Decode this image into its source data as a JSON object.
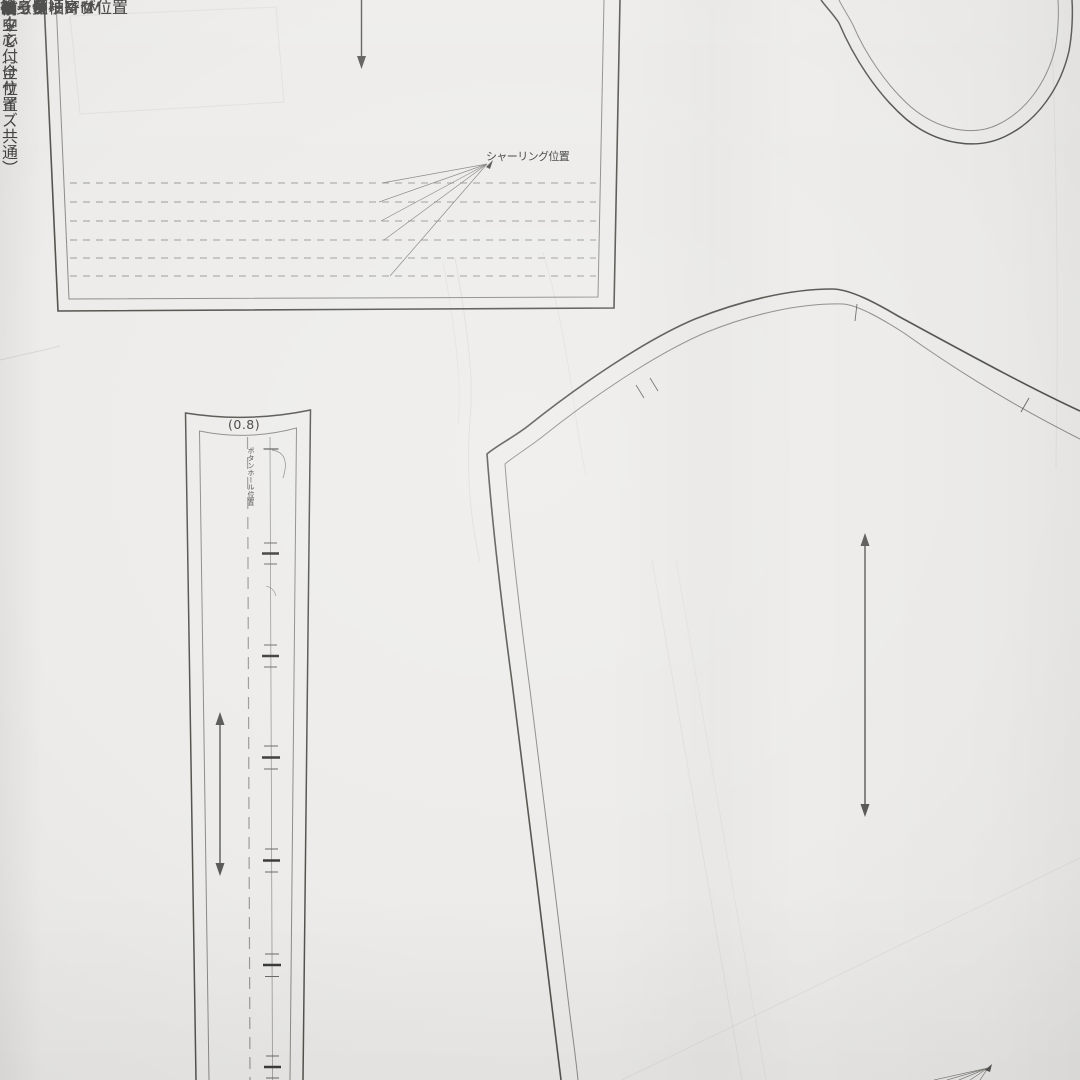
{
  "colors": {
    "paper": "#edecea",
    "outline_dark": "#4f4f4d",
    "outline_mid": "#8b8b89",
    "dashed_line": "#9b9b99",
    "text": "#3f3f3d"
  },
  "pieces": {
    "yoke_top": {
      "shirring_label": "シャーリング位置"
    },
    "placket": {
      "seam_allowance": "(0.8)",
      "buttonhole_label": "ボタンホール位置",
      "button_attach_label": "ボタン付け位置",
      "name_main": "前立て",
      "name_sub": "（全サイズ共通）",
      "center_front_label": "前中心"
    },
    "sleeve": {
      "back_side_label": "後ろ側",
      "name": "袖（長袖）　M",
      "shirring_label": "シャーリング位置"
    },
    "bleed_through": {
      "yoke_label": "ヨーク　M",
      "gather_label": "ギャザー寄せ位置",
      "back_bodice_label": "後ろ身頃　M",
      "front_bodice_label": "前身頃　M"
    }
  }
}
